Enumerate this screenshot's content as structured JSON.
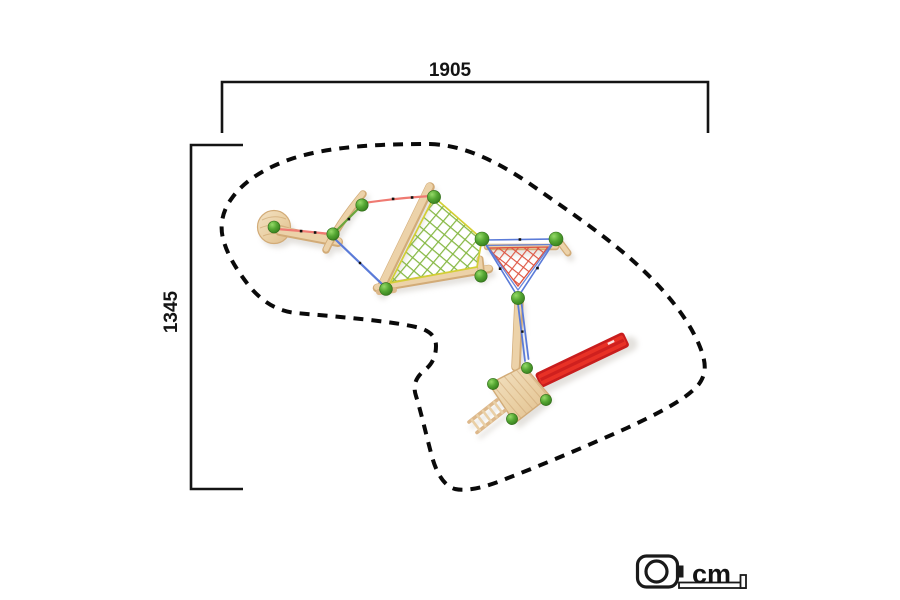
{
  "labels": {
    "width_cm": "1905",
    "height_cm": "1345",
    "unit": "cm"
  },
  "icons": {
    "unit": "measuring-tape-icon"
  },
  "colors": {
    "outline_black": "#0a0a0a",
    "dimension_line": "#141414",
    "wood_light": "#ecd2a9",
    "wood_edge": "#d2ab77",
    "slide_red": "#e32c22",
    "slide_red_dark": "#c81d1d",
    "ball_green": "#4f9f2f",
    "net_green": "#86b843",
    "net_border_yellow": "#d3cf35",
    "net_red": "#dd5340",
    "rope_blue": "#5b7bd8",
    "rope_red": "#ef7a72",
    "rope_green": "#6aa63c",
    "shadow": "#b3aca1"
  }
}
